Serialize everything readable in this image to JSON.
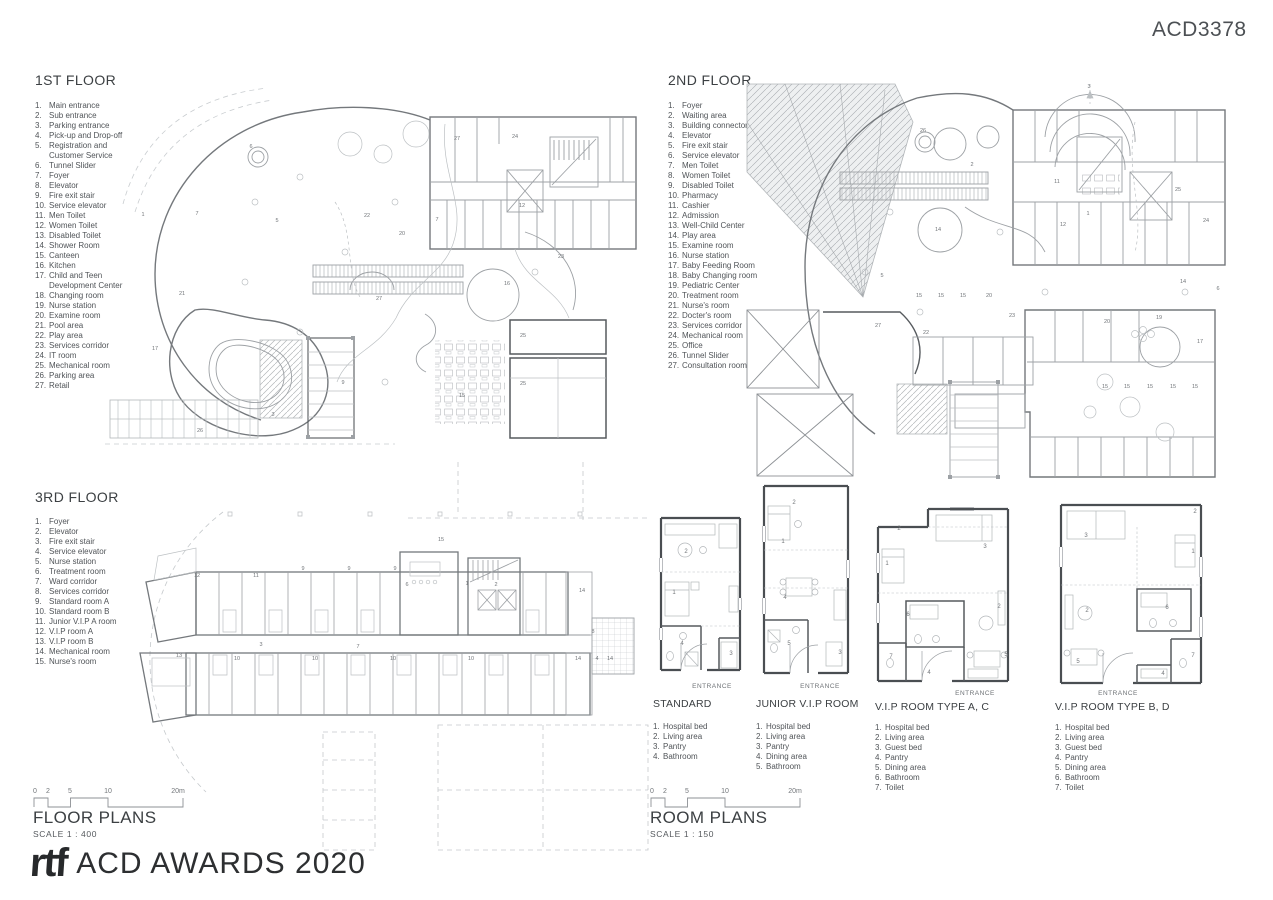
{
  "sheet": {
    "code": "ACD3378"
  },
  "colors": {
    "line_dark": "#565a5e",
    "line_mid": "#74787c",
    "line_light": "#b3b7ba",
    "text_dark": "#3c4043"
  },
  "floors": {
    "first": {
      "title": "1ST FLOOR",
      "items": [
        {
          "n": "1.",
          "label": "Main entrance"
        },
        {
          "n": "2.",
          "label": "Sub entrance"
        },
        {
          "n": "3.",
          "label": "Parking entrance"
        },
        {
          "n": "4.",
          "label": "Pick-up and Drop-off"
        },
        {
          "n": "5.",
          "label": "Registration and Customer Service"
        },
        {
          "n": "6.",
          "label": "Tunnel Slider"
        },
        {
          "n": "7.",
          "label": "Foyer"
        },
        {
          "n": "8.",
          "label": "Elevator"
        },
        {
          "n": "9.",
          "label": "Fire exit stair"
        },
        {
          "n": "10.",
          "label": "Service elevator"
        },
        {
          "n": "11.",
          "label": "Men Toilet"
        },
        {
          "n": "12.",
          "label": "Women Toilet"
        },
        {
          "n": "13.",
          "label": "Disabled Toilet"
        },
        {
          "n": "14.",
          "label": "Shower Room"
        },
        {
          "n": "15.",
          "label": "Canteen"
        },
        {
          "n": "16.",
          "label": "Kitchen"
        },
        {
          "n": "17.",
          "label": "Child and Teen Development Center"
        },
        {
          "n": "18.",
          "label": "Changing room"
        },
        {
          "n": "19.",
          "label": "Nurse station"
        },
        {
          "n": "20.",
          "label": "Examine room"
        },
        {
          "n": "21.",
          "label": "Pool area"
        },
        {
          "n": "22.",
          "label": "Play area"
        },
        {
          "n": "23.",
          "label": "Services corridor"
        },
        {
          "n": "24.",
          "label": "IT room"
        },
        {
          "n": "25.",
          "label": "Mechanical room"
        },
        {
          "n": "26.",
          "label": "Parking area"
        },
        {
          "n": "27.",
          "label": "Retail"
        }
      ]
    },
    "second": {
      "title": "2ND FLOOR",
      "items": [
        {
          "n": "1.",
          "label": "Foyer"
        },
        {
          "n": "2.",
          "label": "Waiting area"
        },
        {
          "n": "3.",
          "label": "Building connector"
        },
        {
          "n": "4.",
          "label": "Elevator"
        },
        {
          "n": "5.",
          "label": "Fire exit stair"
        },
        {
          "n": "6.",
          "label": "Service elevator"
        },
        {
          "n": "7.",
          "label": "Men Toilet"
        },
        {
          "n": "8.",
          "label": "Women Toilet"
        },
        {
          "n": "9.",
          "label": "Disabled Toilet"
        },
        {
          "n": "10.",
          "label": "Pharmacy"
        },
        {
          "n": "11.",
          "label": "Cashier"
        },
        {
          "n": "12.",
          "label": "Admission"
        },
        {
          "n": "13.",
          "label": "Well-Child Center"
        },
        {
          "n": "14.",
          "label": "Play area"
        },
        {
          "n": "15.",
          "label": "Examine room"
        },
        {
          "n": "16.",
          "label": "Nurse station"
        },
        {
          "n": "17.",
          "label": "Baby Feeding Room"
        },
        {
          "n": "18.",
          "label": "Baby Changing room"
        },
        {
          "n": "19.",
          "label": "Pediatric Center"
        },
        {
          "n": "20.",
          "label": "Treatment room"
        },
        {
          "n": "21.",
          "label": "Nurse's room"
        },
        {
          "n": "22.",
          "label": "Docter's room"
        },
        {
          "n": "23.",
          "label": "Services corridor"
        },
        {
          "n": "24.",
          "label": "Mechanical room"
        },
        {
          "n": "25.",
          "label": "Office"
        },
        {
          "n": "26.",
          "label": "Tunnel Slider"
        },
        {
          "n": "27.",
          "label": "Consultation room"
        }
      ]
    },
    "third": {
      "title": "3RD FLOOR",
      "items": [
        {
          "n": "1.",
          "label": "Foyer"
        },
        {
          "n": "2.",
          "label": "Elevator"
        },
        {
          "n": "3.",
          "label": "Fire exit stair"
        },
        {
          "n": "4.",
          "label": "Service elevator"
        },
        {
          "n": "5.",
          "label": "Nurse station"
        },
        {
          "n": "6.",
          "label": "Treatment room"
        },
        {
          "n": "7.",
          "label": "Ward corridor"
        },
        {
          "n": "8.",
          "label": "Services corridor"
        },
        {
          "n": "9.",
          "label": "Standard room A"
        },
        {
          "n": "10.",
          "label": "Standard room B"
        },
        {
          "n": "11.",
          "label": "Junior V.I.P A room"
        },
        {
          "n": "12.",
          "label": "V.I.P room A"
        },
        {
          "n": "13.",
          "label": "V.I.P room B"
        },
        {
          "n": "14.",
          "label": "Mechanical room"
        },
        {
          "n": "15.",
          "label": "Nurse's room"
        }
      ]
    }
  },
  "rooms": {
    "entrance_label": "ENTRANCE",
    "standard": {
      "title": "STANDARD",
      "items": [
        {
          "n": "1.",
          "label": "Hospital bed"
        },
        {
          "n": "2.",
          "label": "Living area"
        },
        {
          "n": "3.",
          "label": "Pantry"
        },
        {
          "n": "4.",
          "label": "Bathroom"
        }
      ]
    },
    "junior": {
      "title": "JUNIOR V.I.P ROOM",
      "items": [
        {
          "n": "1.",
          "label": "Hospital bed"
        },
        {
          "n": "2.",
          "label": "Living area"
        },
        {
          "n": "3.",
          "label": "Pantry"
        },
        {
          "n": "4.",
          "label": "Dining area"
        },
        {
          "n": "5.",
          "label": "Bathroom"
        }
      ]
    },
    "vip_ac": {
      "title": "V.I.P ROOM TYPE A, C",
      "items": [
        {
          "n": "1.",
          "label": "Hospital bed"
        },
        {
          "n": "2.",
          "label": "Living area"
        },
        {
          "n": "3.",
          "label": "Guest bed"
        },
        {
          "n": "4.",
          "label": "Pantry"
        },
        {
          "n": "5.",
          "label": "Dining area"
        },
        {
          "n": "6.",
          "label": "Bathroom"
        },
        {
          "n": "7.",
          "label": "Toilet"
        }
      ]
    },
    "vip_bd": {
      "title": "V.I.P ROOM TYPE B, D",
      "items": [
        {
          "n": "1.",
          "label": "Hospital bed"
        },
        {
          "n": "2.",
          "label": "Living area"
        },
        {
          "n": "3.",
          "label": "Guest bed"
        },
        {
          "n": "4.",
          "label": "Pantry"
        },
        {
          "n": "5.",
          "label": "Dining area"
        },
        {
          "n": "6.",
          "label": "Bathroom"
        },
        {
          "n": "7.",
          "label": "Toilet"
        }
      ]
    }
  },
  "sections": {
    "floor_plans": {
      "title": "FLOOR PLANS",
      "scale": "SCALE 1 : 400"
    },
    "room_plans": {
      "title": "ROOM PLANS",
      "scale": "SCALE 1 : 150"
    }
  },
  "scalebar": {
    "labels": [
      {
        "x": 2,
        "y": 7,
        "t": "0"
      },
      {
        "x": 15,
        "y": 7,
        "t": "2"
      },
      {
        "x": 37,
        "y": 7,
        "t": "5"
      },
      {
        "x": 75,
        "y": 7,
        "t": "10"
      },
      {
        "x": 145,
        "y": 7,
        "t": "20m"
      }
    ]
  },
  "footer": {
    "logo": "rtf",
    "award": "ACD AWARDS 2020"
  },
  "plan_annotations": {
    "first": [
      {
        "x": 48,
        "y": 134,
        "t": "1"
      },
      {
        "x": 102,
        "y": 133,
        "t": "7"
      },
      {
        "x": 156,
        "y": 66,
        "t": "6"
      },
      {
        "x": 182,
        "y": 140,
        "t": "5"
      },
      {
        "x": 87,
        "y": 213,
        "t": "21"
      },
      {
        "x": 272,
        "y": 135,
        "t": "22"
      },
      {
        "x": 307,
        "y": 153,
        "t": "20"
      },
      {
        "x": 362,
        "y": 58,
        "t": "27"
      },
      {
        "x": 420,
        "y": 56,
        "t": "24"
      },
      {
        "x": 342,
        "y": 139,
        "t": "7"
      },
      {
        "x": 427,
        "y": 125,
        "t": "12"
      },
      {
        "x": 466,
        "y": 176,
        "t": "23"
      },
      {
        "x": 412,
        "y": 203,
        "t": "16"
      },
      {
        "x": 284,
        "y": 218,
        "t": "27"
      },
      {
        "x": 428,
        "y": 255,
        "t": "25"
      },
      {
        "x": 428,
        "y": 303,
        "t": "25"
      },
      {
        "x": 367,
        "y": 315,
        "t": "15"
      },
      {
        "x": 178,
        "y": 334,
        "t": "3"
      },
      {
        "x": 105,
        "y": 350,
        "t": "26"
      },
      {
        "x": 60,
        "y": 268,
        "t": "17"
      },
      {
        "x": 248,
        "y": 302,
        "t": "9"
      }
    ],
    "second": [
      {
        "x": 344,
        "y": 6,
        "t": "3"
      },
      {
        "x": 178,
        "y": 50,
        "t": "26"
      },
      {
        "x": 227,
        "y": 84,
        "t": "2"
      },
      {
        "x": 312,
        "y": 101,
        "t": "11"
      },
      {
        "x": 343,
        "y": 133,
        "t": "1"
      },
      {
        "x": 433,
        "y": 109,
        "t": "25"
      },
      {
        "x": 461,
        "y": 140,
        "t": "24"
      },
      {
        "x": 318,
        "y": 144,
        "t": "12"
      },
      {
        "x": 193,
        "y": 149,
        "t": "14"
      },
      {
        "x": 137,
        "y": 195,
        "t": "5"
      },
      {
        "x": 174,
        "y": 215,
        "t": "15"
      },
      {
        "x": 196,
        "y": 215,
        "t": "15"
      },
      {
        "x": 218,
        "y": 215,
        "t": "15"
      },
      {
        "x": 244,
        "y": 215,
        "t": "20"
      },
      {
        "x": 267,
        "y": 235,
        "t": "23"
      },
      {
        "x": 133,
        "y": 245,
        "t": "27"
      },
      {
        "x": 181,
        "y": 252,
        "t": "22"
      },
      {
        "x": 362,
        "y": 241,
        "t": "20"
      },
      {
        "x": 414,
        "y": 237,
        "t": "19"
      },
      {
        "x": 438,
        "y": 201,
        "t": "14"
      },
      {
        "x": 473,
        "y": 208,
        "t": "6"
      },
      {
        "x": 455,
        "y": 261,
        "t": "17"
      },
      {
        "x": 360,
        "y": 306,
        "t": "15"
      },
      {
        "x": 382,
        "y": 306,
        "t": "15"
      },
      {
        "x": 405,
        "y": 306,
        "t": "15"
      },
      {
        "x": 428,
        "y": 306,
        "t": "15"
      },
      {
        "x": 450,
        "y": 306,
        "t": "15"
      }
    ],
    "third": [
      {
        "x": 69,
        "y": 117,
        "t": "12"
      },
      {
        "x": 128,
        "y": 117,
        "t": "11"
      },
      {
        "x": 175,
        "y": 110,
        "t": "9"
      },
      {
        "x": 221,
        "y": 110,
        "t": "9"
      },
      {
        "x": 267,
        "y": 110,
        "t": "9"
      },
      {
        "x": 279,
        "y": 126,
        "t": "6"
      },
      {
        "x": 313,
        "y": 81,
        "t": "15"
      },
      {
        "x": 339,
        "y": 125,
        "t": "1"
      },
      {
        "x": 368,
        "y": 126,
        "t": "2"
      },
      {
        "x": 51,
        "y": 197,
        "t": "13"
      },
      {
        "x": 133,
        "y": 186,
        "t": "3"
      },
      {
        "x": 109,
        "y": 200,
        "t": "10"
      },
      {
        "x": 187,
        "y": 200,
        "t": "10"
      },
      {
        "x": 265,
        "y": 200,
        "t": "10"
      },
      {
        "x": 343,
        "y": 200,
        "t": "10"
      },
      {
        "x": 454,
        "y": 132,
        "t": "14"
      },
      {
        "x": 465,
        "y": 173,
        "t": "8"
      },
      {
        "x": 450,
        "y": 200,
        "t": "14"
      },
      {
        "x": 469,
        "y": 200,
        "t": "4"
      },
      {
        "x": 482,
        "y": 200,
        "t": "14"
      },
      {
        "x": 230,
        "y": 188,
        "t": "7"
      }
    ],
    "standard": [
      {
        "x": 33,
        "y": 43,
        "t": "2"
      },
      {
        "x": 21,
        "y": 84,
        "t": "1"
      },
      {
        "x": 29,
        "y": 135,
        "t": "4"
      },
      {
        "x": 78,
        "y": 145,
        "t": "3"
      }
    ],
    "junior": [
      {
        "x": 38,
        "y": 24,
        "t": "2"
      },
      {
        "x": 27,
        "y": 63,
        "t": "1"
      },
      {
        "x": 29,
        "y": 119,
        "t": "4"
      },
      {
        "x": 33,
        "y": 165,
        "t": "5"
      },
      {
        "x": 84,
        "y": 174,
        "t": "3"
      }
    ],
    "vip_ac": [
      {
        "x": 29,
        "y": 27,
        "t": "2"
      },
      {
        "x": 17,
        "y": 62,
        "t": "1"
      },
      {
        "x": 115,
        "y": 45,
        "t": "3"
      },
      {
        "x": 129,
        "y": 105,
        "t": "2"
      },
      {
        "x": 38,
        "y": 113,
        "t": "6"
      },
      {
        "x": 21,
        "y": 155,
        "t": "7"
      },
      {
        "x": 59,
        "y": 171,
        "t": "4"
      },
      {
        "x": 136,
        "y": 153,
        "t": "5"
      }
    ],
    "vip_bd": [
      {
        "x": 142,
        "y": 16,
        "t": "2"
      },
      {
        "x": 33,
        "y": 40,
        "t": "3"
      },
      {
        "x": 140,
        "y": 56,
        "t": "1"
      },
      {
        "x": 34,
        "y": 115,
        "t": "2"
      },
      {
        "x": 114,
        "y": 112,
        "t": "6"
      },
      {
        "x": 25,
        "y": 166,
        "t": "5"
      },
      {
        "x": 110,
        "y": 178,
        "t": "4"
      },
      {
        "x": 140,
        "y": 160,
        "t": "7"
      }
    ]
  }
}
